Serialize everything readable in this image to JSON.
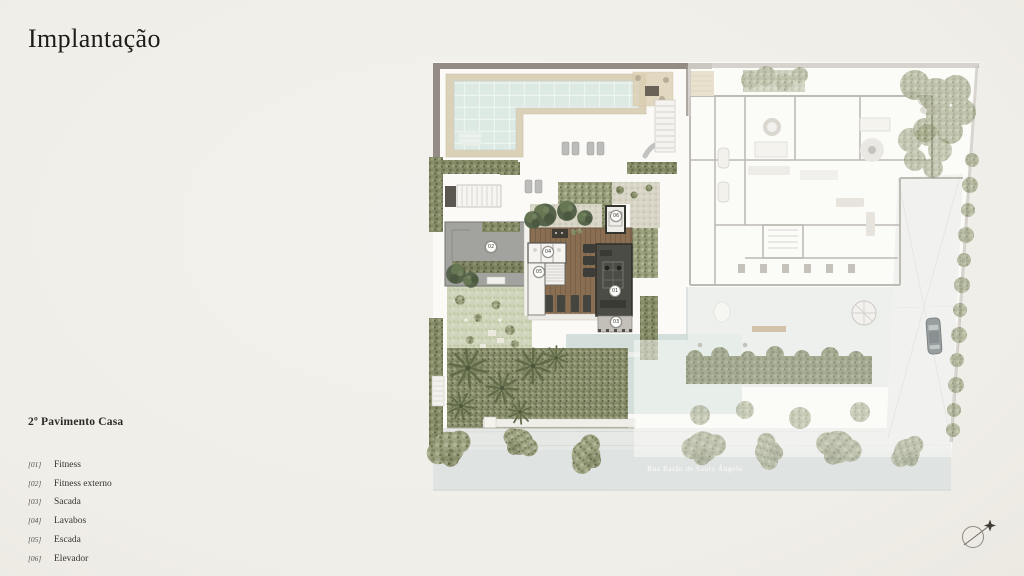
{
  "page": {
    "title": "Implantação"
  },
  "legend": {
    "heading": "2º Pavimento Casa",
    "items": [
      {
        "num": "[01]",
        "label": "Fitness"
      },
      {
        "num": "[02]",
        "label": "Fitness externo"
      },
      {
        "num": "[03]",
        "label": "Sacada"
      },
      {
        "num": "[04]",
        "label": "Lavabos"
      },
      {
        "num": "[05]",
        "label": "Escada"
      },
      {
        "num": "[06]",
        "label": "Elevador"
      }
    ]
  },
  "plan": {
    "street_label": "Rua Barão de Santo Ângelo",
    "markers": [
      {
        "num": "01",
        "x": 615,
        "y": 291
      },
      {
        "num": "02",
        "x": 491,
        "y": 247
      },
      {
        "num": "03",
        "x": 616,
        "y": 322
      },
      {
        "num": "04",
        "x": 548,
        "y": 252
      },
      {
        "num": "05",
        "x": 539,
        "y": 272
      },
      {
        "num": "06",
        "x": 616,
        "y": 216
      }
    ],
    "compass_icon": "north-arrow"
  },
  "colors": {
    "paper": "#f0eee8",
    "ink": "#1e1c19",
    "deck_wood": "#8a6e52",
    "pool_water": "#dde9e3",
    "vegetation": "#9aa07e",
    "street": "#dfe3e1",
    "highlight_roof": "#a2a29e"
  }
}
